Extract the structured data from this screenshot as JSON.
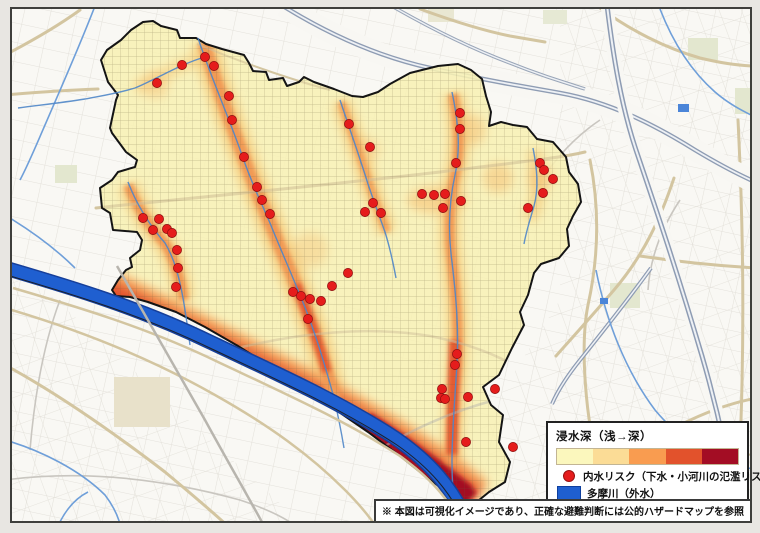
{
  "legend": {
    "title": "浸水深（浅→深）",
    "ramp_colors": [
      "#fbf7bd",
      "#fbdc96",
      "#f99c50",
      "#e2522c",
      "#a30d24"
    ],
    "items": [
      {
        "id": "inland-risk",
        "marker": "red-dot",
        "marker_color": "#e51c1c",
        "label": "内水リスク（下水・小河川の氾濫リスク）"
      },
      {
        "id": "tamagawa",
        "marker": "blue-swatch",
        "marker_color": "#1f5fd0",
        "label": "多摩川（外水）"
      }
    ]
  },
  "footnote": "※ 本図は可視化イメージであり、正確な避難判断には公的ハザードマップを参照",
  "map": {
    "heat_ramp": [
      "#f7f0b4",
      "#f9e09c",
      "#f7a855",
      "#e55c30",
      "#a30d24"
    ],
    "river_color": "#1f5fd0",
    "risk_point_color": "#e51c1c",
    "risk_points": [
      [
        205,
        57
      ],
      [
        214,
        66
      ],
      [
        229,
        96
      ],
      [
        232,
        120
      ],
      [
        244,
        157
      ],
      [
        257,
        187
      ],
      [
        262,
        200
      ],
      [
        270,
        214
      ],
      [
        182,
        65
      ],
      [
        157,
        83
      ],
      [
        143,
        218
      ],
      [
        153,
        230
      ],
      [
        159,
        219
      ],
      [
        167,
        229
      ],
      [
        172,
        233
      ],
      [
        177,
        250
      ],
      [
        178,
        268
      ],
      [
        176,
        287
      ],
      [
        293,
        292
      ],
      [
        301,
        296
      ],
      [
        310,
        299
      ],
      [
        321,
        301
      ],
      [
        308,
        319
      ],
      [
        332,
        286
      ],
      [
        348,
        273
      ],
      [
        349,
        124
      ],
      [
        370,
        147
      ],
      [
        373,
        203
      ],
      [
        365,
        212
      ],
      [
        381,
        213
      ],
      [
        422,
        194
      ],
      [
        434,
        195
      ],
      [
        445,
        194
      ],
      [
        461,
        201
      ],
      [
        443,
        208
      ],
      [
        460,
        113
      ],
      [
        460,
        129
      ],
      [
        456,
        163
      ],
      [
        540,
        163
      ],
      [
        544,
        170
      ],
      [
        553,
        179
      ],
      [
        543,
        193
      ],
      [
        528,
        208
      ],
      [
        457,
        354
      ],
      [
        455,
        365
      ],
      [
        442,
        389
      ],
      [
        441,
        398
      ],
      [
        445,
        399
      ],
      [
        468,
        397
      ],
      [
        495,
        389
      ],
      [
        466,
        442
      ],
      [
        513,
        447
      ]
    ]
  }
}
